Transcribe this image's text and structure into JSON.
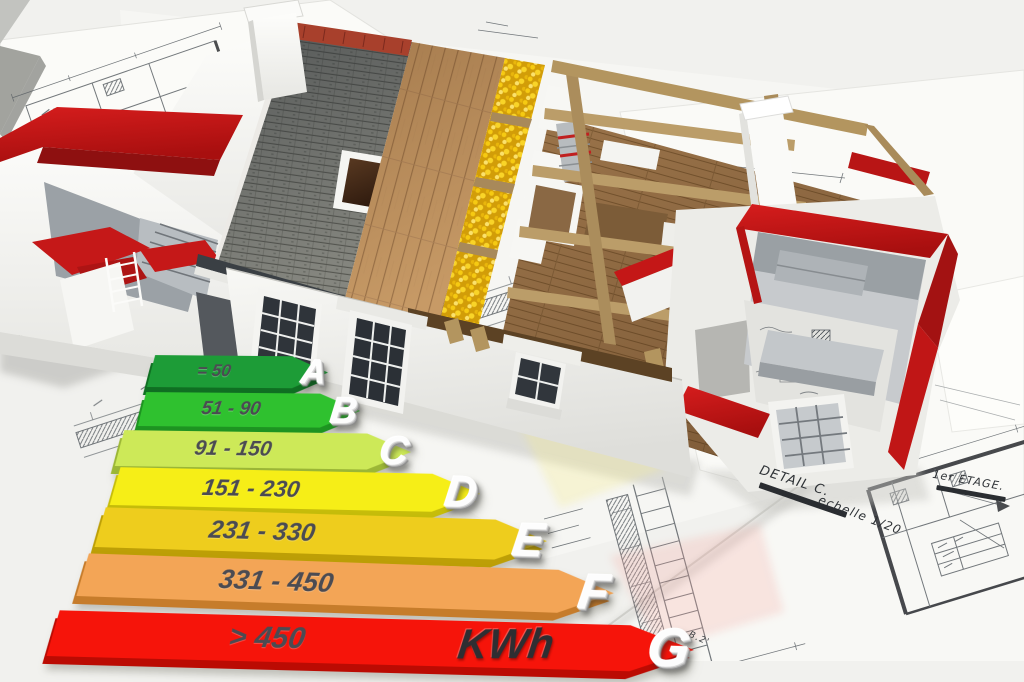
{
  "chart_data": {
    "type": "bar",
    "subtype": "energy-efficiency-rating-scale",
    "orientation": "horizontal-arrows",
    "unit_label": "KWh",
    "categories": [
      "A",
      "B",
      "C",
      "D",
      "E",
      "F",
      "G"
    ],
    "series": [
      {
        "name": "kWh range",
        "values": [
          "= 50",
          "51 - 90",
          "91 - 150",
          "151 - 230",
          "231 - 330",
          "331 - 450",
          "> 450"
        ]
      }
    ],
    "bar_colors": [
      "#1d9c37",
      "#2fc12f",
      "#cde958",
      "#f6ee17",
      "#eecd1d",
      "#f3a556",
      "#f6140a"
    ],
    "bar_edge_colors": [
      "#0f6f22",
      "#1d9421",
      "#9cb736",
      "#c6bd0a",
      "#bd9f06",
      "#c67c2b",
      "#bb0b03"
    ],
    "axes": "none",
    "legend": "none"
  },
  "annotations": {
    "detail_label": "DETAIL C.",
    "scale_label": "echelle 1/20",
    "floor_label": "1er ETAGE.",
    "corner_note": "B.2'"
  },
  "scene_colors": {
    "roof_slate": "#85867f",
    "roof_ridge": "#a8402c",
    "wood_sheathing": "#c79a66",
    "insulation": "#f0c414",
    "timber_frame": "#b3955f",
    "wood_floor": "#9b744a",
    "wall_caps_red": "#c41717",
    "walls_white": "#f4f4f1"
  }
}
